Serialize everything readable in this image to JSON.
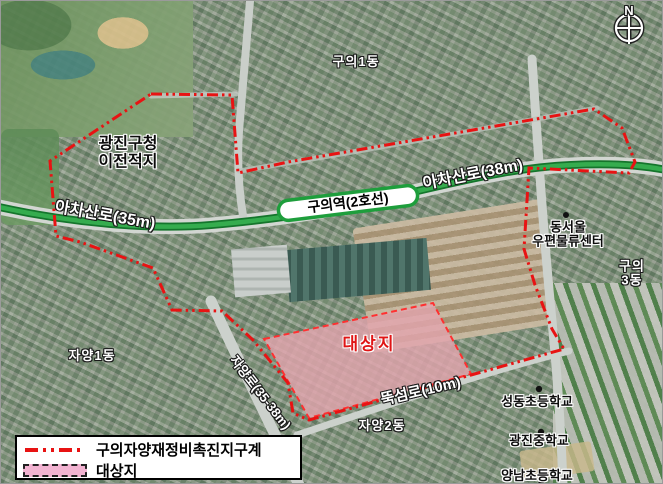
{
  "compass": {
    "north_label": "N"
  },
  "station": {
    "label": "구의역(2호선)"
  },
  "roads": [
    {
      "label": "아차산로(35m)"
    },
    {
      "label": "아차산로(38m)"
    },
    {
      "label": "자양로(35-38m)"
    },
    {
      "label": "뚝섬로(10m)"
    }
  ],
  "districts": [
    {
      "label": "구의1동"
    },
    {
      "label": "구의3동"
    },
    {
      "label": "자양1동"
    },
    {
      "label": "자양2동"
    }
  ],
  "places": [
    {
      "label": "광진구청\n이전적지"
    },
    {
      "label": "동서울\n우편물류센터"
    },
    {
      "label": "성동초등학교"
    },
    {
      "label": "광진중학교"
    },
    {
      "label": "양남초등학교"
    }
  ],
  "site": {
    "label": "대상지"
  },
  "legend": {
    "items": [
      {
        "label": "구의자양재정비촉진지구계",
        "symbol": "red-dashdot-boundary-line",
        "color": "#e81313"
      },
      {
        "label": "대상지",
        "symbol": "pink-filled-area",
        "color": "#f2b3d1"
      }
    ]
  },
  "colors": {
    "boundary_red": "#e81313",
    "site_pink": "#f5b6cb",
    "road_green": "#2f9e45"
  }
}
